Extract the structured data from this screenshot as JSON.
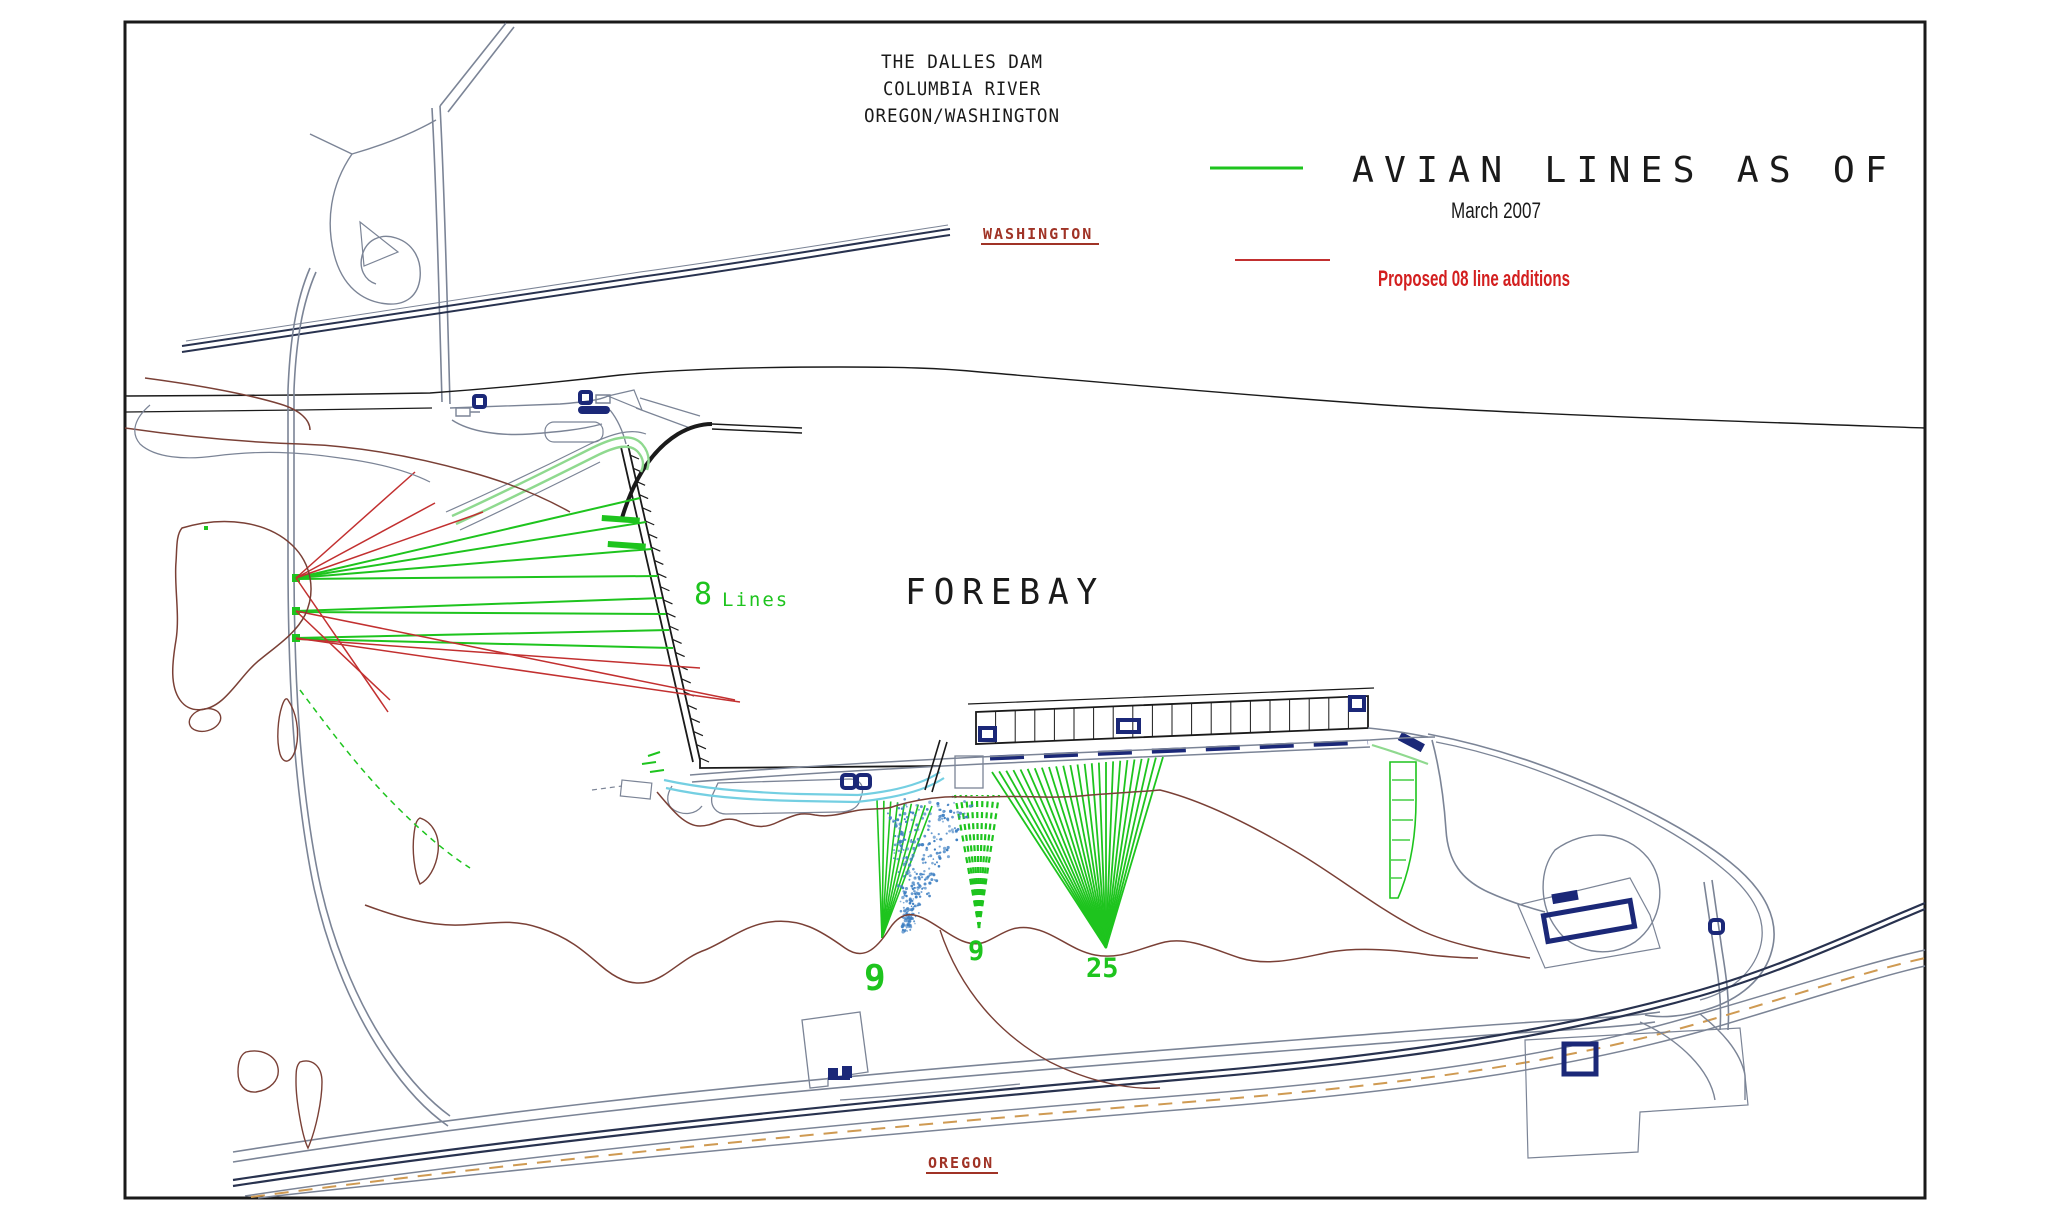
{
  "title_block": {
    "line1": "THE DALLES DAM",
    "line2": "COLUMBIA RIVER",
    "line3": "OREGON/WASHINGTON"
  },
  "legend": {
    "avian_title": "AVIAN LINES AS OF",
    "avian_date": "March 2007",
    "proposed_label": "Proposed 08 line additions"
  },
  "region_labels": {
    "north": "WASHINGTON",
    "south": "OREGON"
  },
  "map_labels": {
    "water_body": "FOREBAY",
    "spillway_lines_count": "8",
    "spillway_lines_word": "Lines",
    "fan_west_count": "9",
    "fan_middle_count": "9",
    "fan_east_count": "25"
  },
  "avian_line_summary": {
    "spillway_lines": 8,
    "west_fan_lines": 9,
    "middle_fan_lines": 9,
    "east_fan_lines": 25
  },
  "colors": {
    "ink": "#1a1a1a",
    "road": "#7b8496",
    "rail": "#28324f",
    "navy": "#1b2878",
    "shore": "#7a4036",
    "avian": "#1ec41e",
    "lightgreen": "#8fd98f",
    "red": "#c23030",
    "redtext": "#d31f1f",
    "statered": "#a03326",
    "cyan": "#74cfe2",
    "speckle": "#3e7fc2",
    "orange": "#cf9a52"
  },
  "fans": [
    {
      "name": "west-fan",
      "count": 9,
      "apex": [
        882,
        938
      ],
      "top_start": [
        877,
        800
      ],
      "top_end": [
        932,
        806
      ],
      "dash": null,
      "width": 1.6
    },
    {
      "name": "middle-fan",
      "count": 9,
      "apex": [
        979,
        928
      ],
      "top_start": [
        955,
        795
      ],
      "top_end": [
        999,
        795
      ],
      "dash": "6 5",
      "width": 2.2
    },
    {
      "name": "east-fan",
      "count": 25,
      "apex": [
        1106,
        948
      ],
      "top_start": [
        992,
        772
      ],
      "top_end": [
        1163,
        757
      ],
      "dash": null,
      "width": 1.8
    }
  ],
  "left_lines": [
    [
      296,
      578,
      640,
      498
    ],
    [
      296,
      578,
      646,
      522
    ],
    [
      296,
      578,
      652,
      549
    ],
    [
      296,
      579,
      658,
      576
    ],
    [
      296,
      611,
      662,
      598
    ],
    [
      296,
      612,
      666,
      614
    ],
    [
      296,
      638,
      669,
      630
    ],
    [
      296,
      639,
      673,
      648
    ]
  ],
  "proposed_lines": [
    [
      296,
      578,
      415,
      472
    ],
    [
      296,
      578,
      435,
      503
    ],
    [
      296,
      578,
      483,
      512
    ],
    [
      296,
      578,
      388,
      712
    ],
    [
      296,
      611,
      390,
      700
    ],
    [
      296,
      611,
      735,
      700
    ],
    [
      296,
      638,
      740,
      702
    ],
    [
      296,
      639,
      700,
      668
    ]
  ],
  "speckle": {
    "count": 330,
    "apex": [
      906,
      930
    ],
    "top_left": [
      886,
      798
    ],
    "top_right": [
      978,
      798
    ]
  }
}
